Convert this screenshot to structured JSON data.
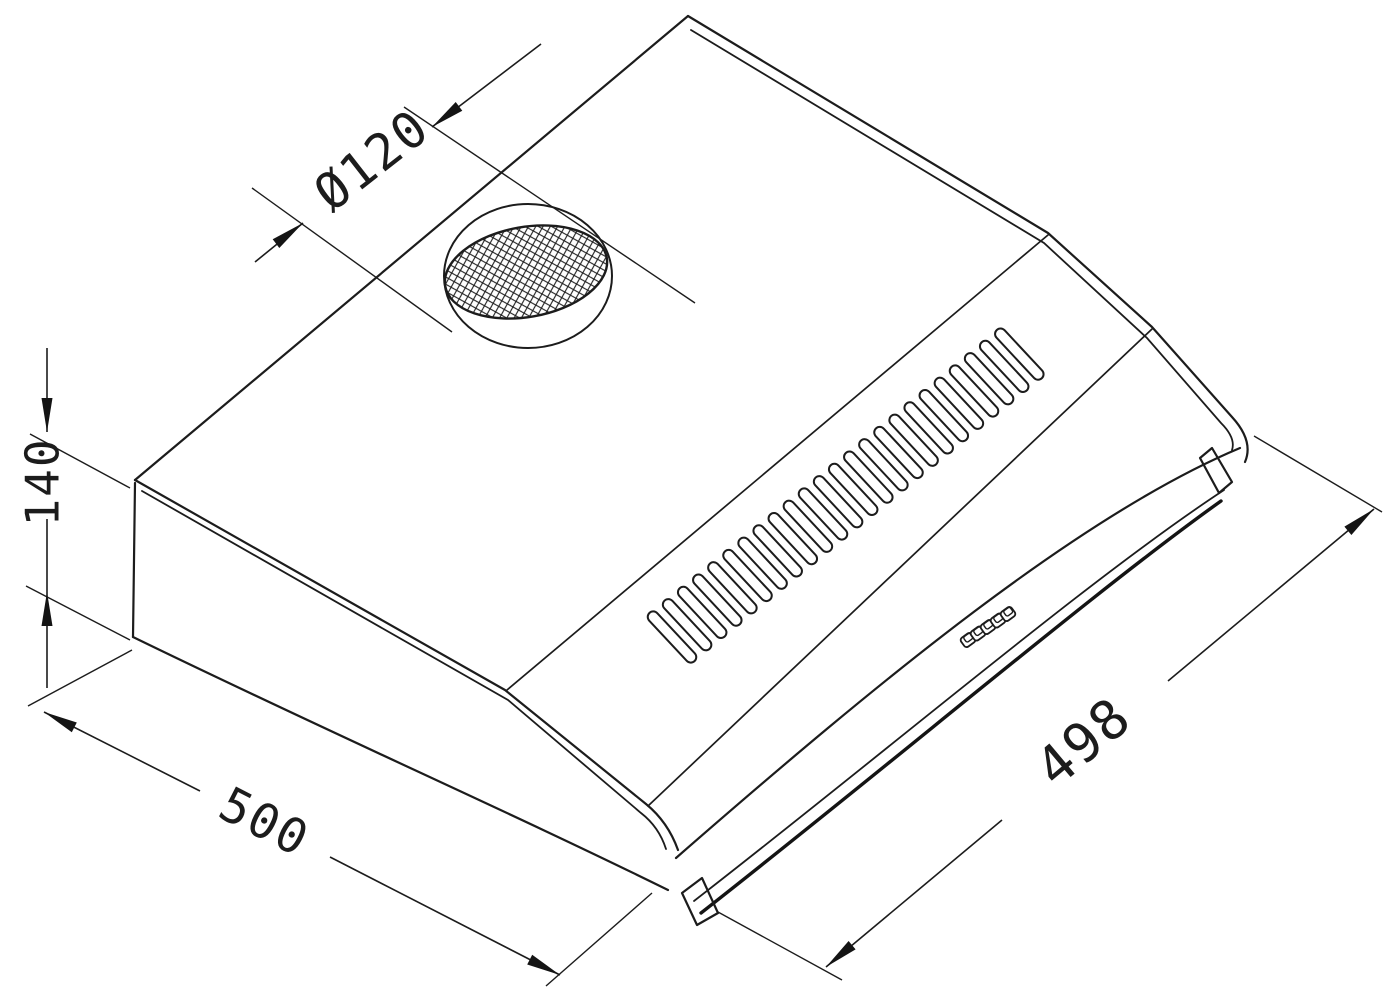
{
  "drawing": {
    "subject": "cooker-hood-isometric-technical-drawing",
    "colors": {
      "background": "#ffffff",
      "line": "#1c1c1c"
    },
    "annotations": {
      "duct_diameter": {
        "label": "Ø120"
      },
      "height": {
        "label": "140"
      },
      "depth": {
        "label": "500"
      },
      "width": {
        "label": "498"
      }
    },
    "features": {
      "vent_slot_count": 24,
      "control_button_count": 5
    }
  }
}
